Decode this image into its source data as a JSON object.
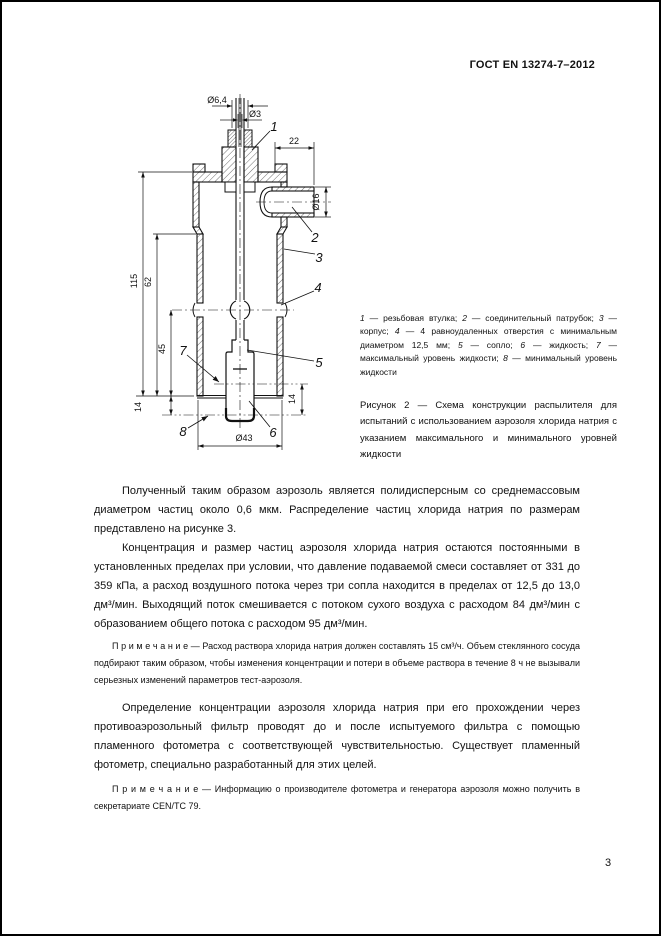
{
  "page": {
    "header": "ГОСТ EN 13274-7–2012",
    "page_number": "3"
  },
  "figure": {
    "dims": {
      "d64": "Ø6,4",
      "d3": "Ø3",
      "d22": "22",
      "d16": "Ø16",
      "d115": "115",
      "d62": "62",
      "d45": "45",
      "d14_left": "14",
      "d14_right": "14",
      "d43": "Ø43"
    },
    "callouts": {
      "c1": "1",
      "c2": "2",
      "c3": "3",
      "c4": "4",
      "c5": "5",
      "c6": "6",
      "c7": "7",
      "c8": "8"
    },
    "legend_items": [
      {
        "num": "1",
        "text": "резьбовая втулка"
      },
      {
        "num": "2",
        "text": "соединительный патрубок"
      },
      {
        "num": "3",
        "text": "корпус"
      },
      {
        "num": "4",
        "text": "4 равноудаленных отверстия с минимальным диаметром 12,5 мм"
      },
      {
        "num": "5",
        "text": "сопло"
      },
      {
        "num": "6",
        "text": "жидкость"
      },
      {
        "num": "7",
        "text": "максимальный уровень жидкости"
      },
      {
        "num": "8",
        "text": "минимальный уровень жидкости"
      }
    ],
    "caption_label": "Рисунок 2",
    "caption_text": "— Схема конструкции распылителя для испытаний с использованием аэрозоля хлорида натрия с указанием максимального и минимального уровней жидкости"
  },
  "content": {
    "paragraphs": {
      "p1": "Полученный таким образом аэрозоль является полидисперсным со среднемассовым диаметром частиц около 0,6 мкм. Распределение частиц хлорида натрия по размерам представлено на рисунке 3.",
      "p2": "Концентрация и размер частиц аэрозоля хлорида натрия остаются постоянными в установленных пределах при условии, что давление подаваемой смеси составляет от 331 до 359 кПа, а расход воздушного потока через три сопла находится в пределах от 12,5 до 13,0 дм³/мин. Выходящий поток смешивается с потоком сухого воздуха с расходом 84 дм³/мин с образованием общего потока с расходом 95 дм³/мин.",
      "p3": "Определение концентрации аэрозоля хлорида натрия при его прохождении через противоаэрозольный фильтр проводят до и после испытуемого фильтра с помощью пламенного фотометра с соответствующей чувствительностью. Существует пламенный фотометр, специально разработанный для этих целей."
    },
    "notes": {
      "label": "П р и м е ч а н и е",
      "n1": "— Расход раствора хлорида натрия должен составлять 15 см³/ч. Объем стеклянного сосуда подбирают таким образом, чтобы изменения концентрации и потери в объеме раствора в течение 8 ч не вызывали серьезных изменений параметров тест-аэрозоля.",
      "n2": "— Информацию о производителе фотометра и генератора аэрозоля можно получить в секретариате CEN/TC 79."
    }
  }
}
